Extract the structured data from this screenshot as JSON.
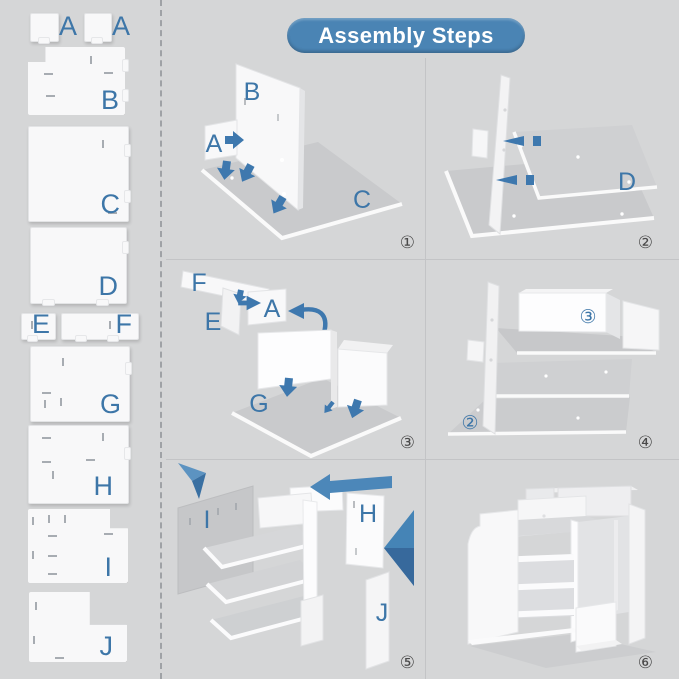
{
  "title": "Assembly Steps",
  "colors": {
    "banner_blue": "#4a84b4",
    "label_blue": "#3d76a8",
    "arrow_blue": "#3e78ae",
    "background_gray": "#d5d6d7",
    "panel_white": "#f8f8f9",
    "base_gray": "#c9cacc",
    "step_number_gray": "#4a4a4a"
  },
  "sidebar": {
    "parts": [
      {
        "id": "A1",
        "label": "A"
      },
      {
        "id": "A2",
        "label": "A"
      },
      {
        "id": "B",
        "label": "B"
      },
      {
        "id": "C",
        "label": "C"
      },
      {
        "id": "D",
        "label": "D"
      },
      {
        "id": "E",
        "label": "E"
      },
      {
        "id": "F",
        "label": "F"
      },
      {
        "id": "G",
        "label": "G"
      },
      {
        "id": "H",
        "label": "H"
      },
      {
        "id": "I",
        "label": "I"
      },
      {
        "id": "J",
        "label": "J"
      }
    ]
  },
  "steps": [
    {
      "number": "①",
      "labels": {
        "B": "B",
        "A": "A",
        "C": "C"
      }
    },
    {
      "number": "②",
      "labels": {
        "D": "D"
      }
    },
    {
      "number": "③",
      "labels": {
        "F": "F",
        "E": "E",
        "A": "A",
        "G": "G"
      }
    },
    {
      "number": "④",
      "labels": {
        "unit3": "③",
        "unit2": "②"
      }
    },
    {
      "number": "⑤",
      "labels": {
        "I": "I",
        "H": "H",
        "J": "J"
      }
    },
    {
      "number": "⑥",
      "labels": {}
    }
  ]
}
